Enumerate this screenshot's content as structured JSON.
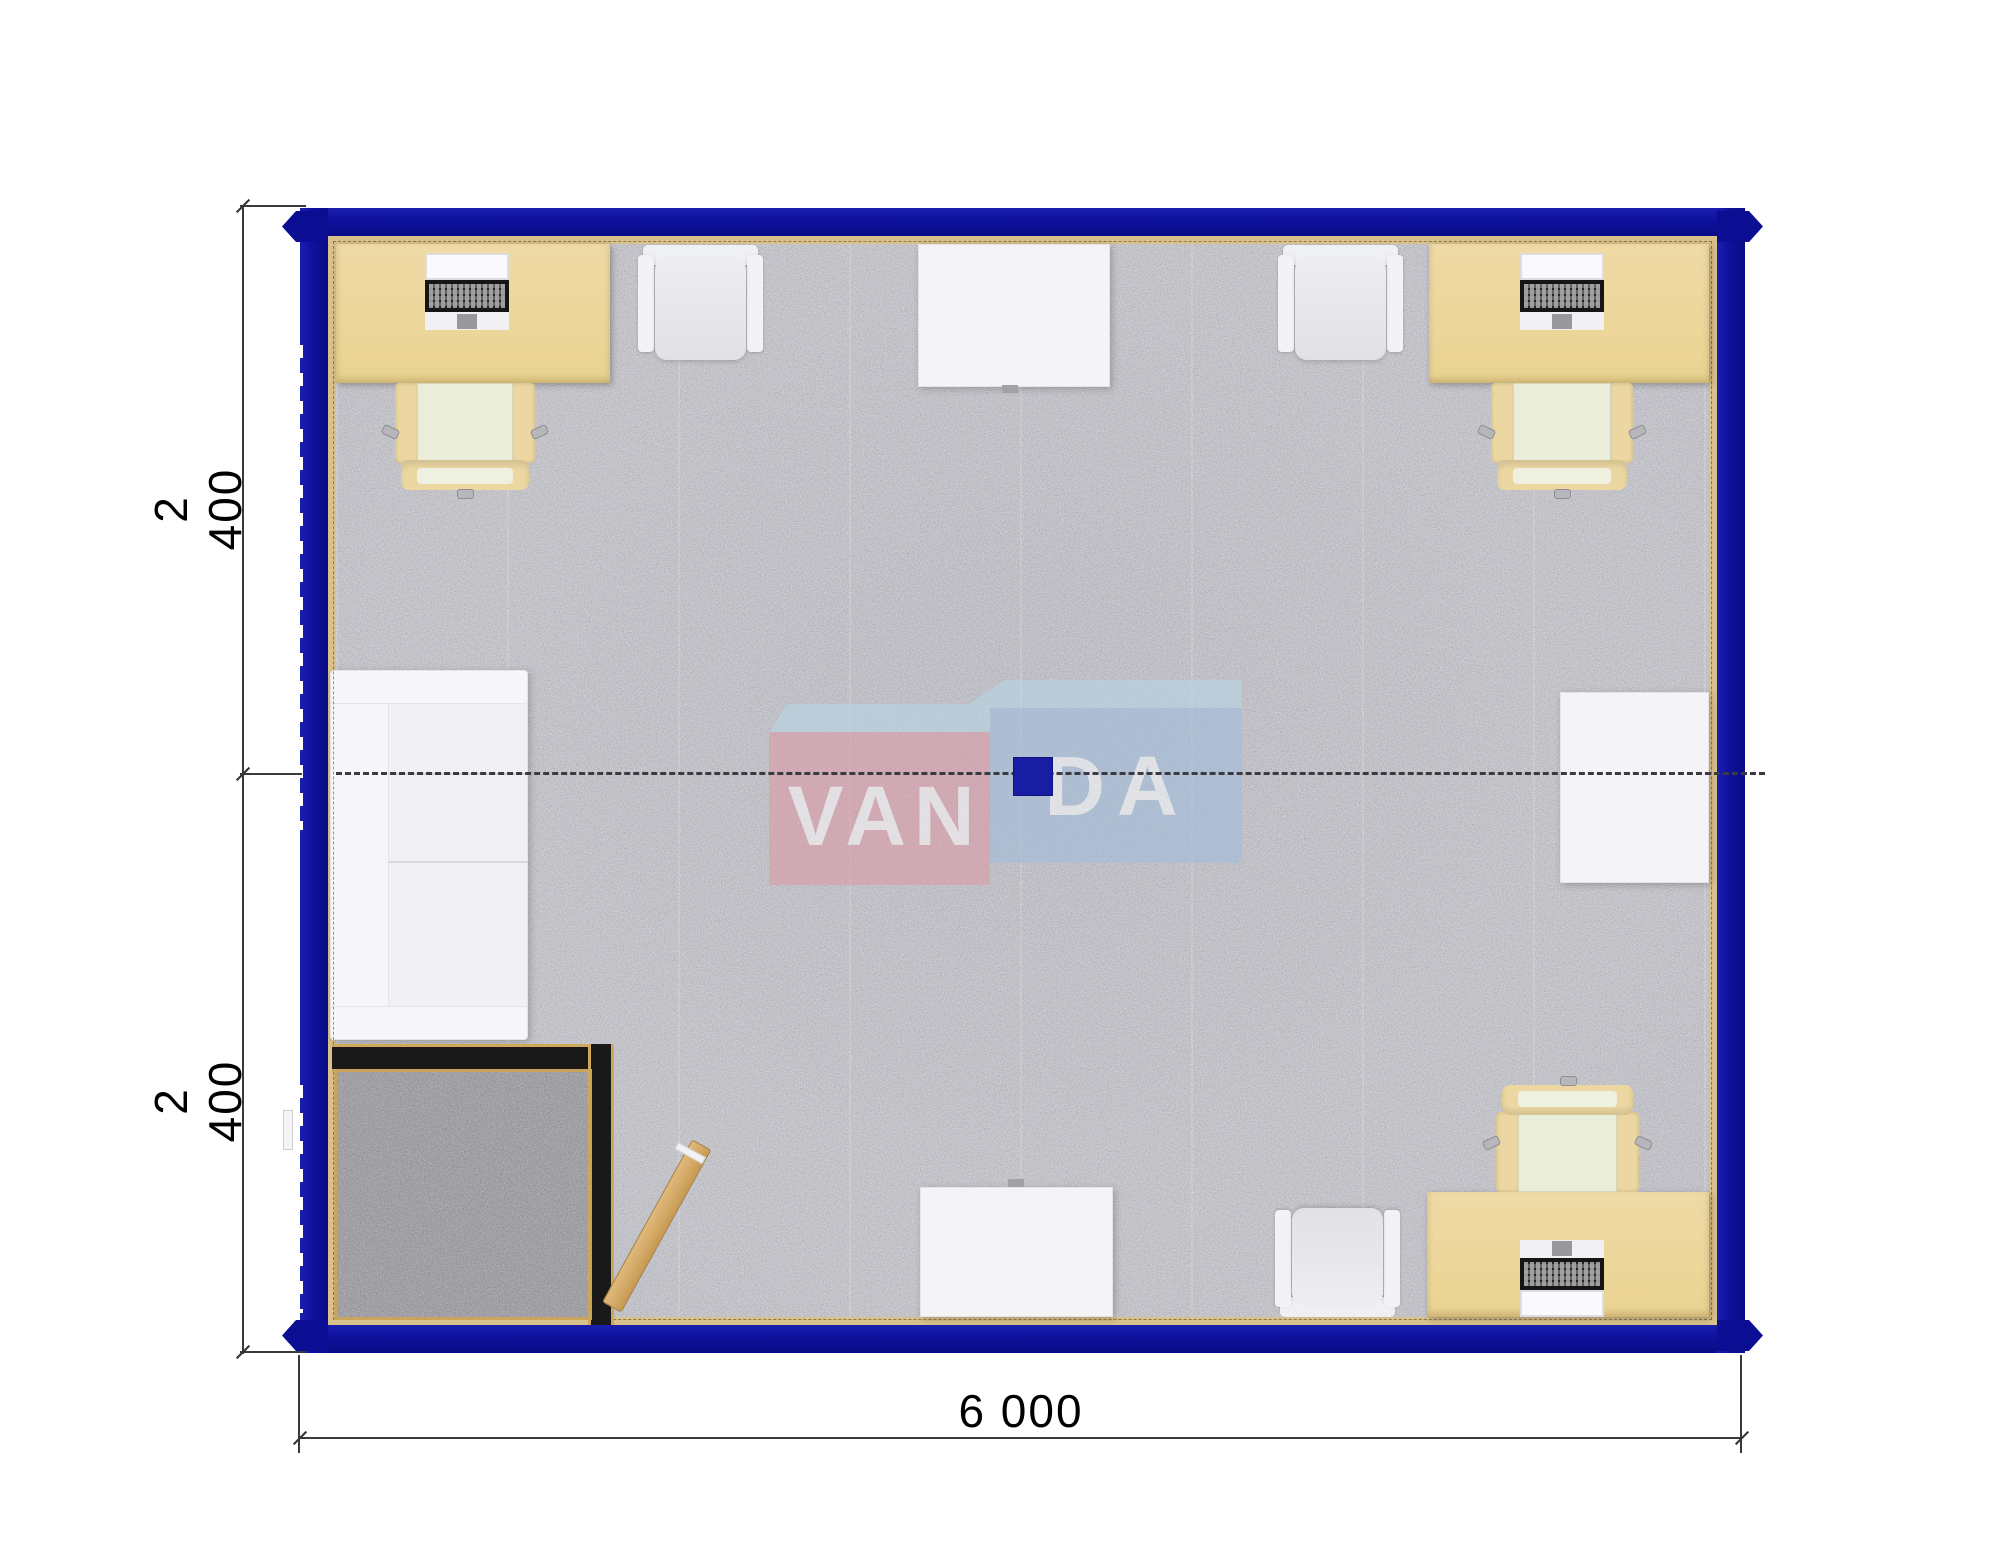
{
  "plan": {
    "type": "modular-office-floor-plan",
    "dimension_labels": {
      "left_upper": "2 400",
      "left_lower": "2 400",
      "bottom": "6 000"
    },
    "watermark": {
      "brand": "VANDA",
      "left_text": "VAN",
      "right_text": "DA",
      "pink_hex": "#dd9aa6",
      "blue_hex": "#a2bddc",
      "top_face_hex": "#b9d6e8"
    },
    "colors": {
      "frame_blue": "#0e119c",
      "wall_lining_tan": "#d8c18b",
      "carpet_gray": "#c8c9ce",
      "vestibule_carpet_gray": "#97969a",
      "vestibule_wall_black": "#191919",
      "trim_gold": "#c9a45b",
      "desk_beige": "#ecd69f",
      "chair_seat_cream": "#e9edda",
      "white_furniture": "#f3f3f6",
      "door_wood": "#d2a964",
      "column_blue": "#181da3"
    },
    "furniture_inventory": {
      "desks_with_computers": 3,
      "office_chairs": 3,
      "side_chairs": 3,
      "tables": 3,
      "sofas": 1,
      "entrance_doors": 1,
      "support_columns": 1
    }
  }
}
